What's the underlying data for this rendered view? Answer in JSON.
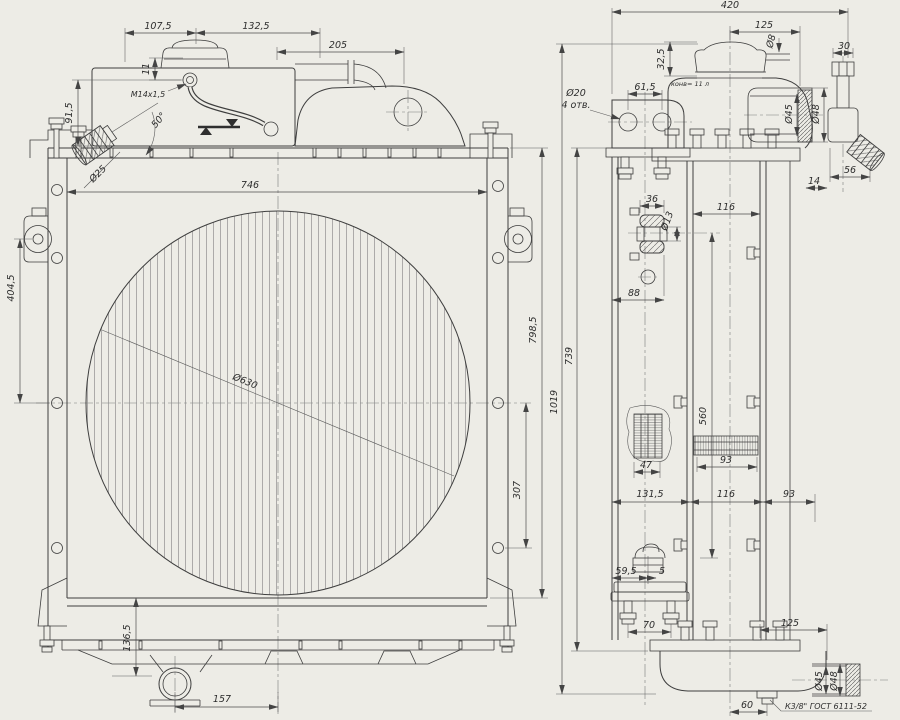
{
  "front": {
    "d107_5": "107,5",
    "d132_5": "132,5",
    "d205": "205",
    "d11": "11",
    "thread": "М14х1,5",
    "d91_5": "91,5",
    "a50": "50°",
    "d25": "Ø25",
    "d746": "746",
    "dfan": "Ø630",
    "d798_5": "798,5",
    "d307": "307",
    "d404_5": "404,5",
    "d136_5": "136,5",
    "d157": "157"
  },
  "side": {
    "d420": "420",
    "d125t": "125",
    "d8": "Ø8",
    "d32_5": "32,5",
    "d30": "30",
    "d20": "Ø20",
    "n4otv": "4 отв.",
    "d61_5": "61,5",
    "note_cap": "конв= 11 л",
    "d45t": "Ø45",
    "d48t": "Ø48",
    "d56": "56",
    "d14": "14",
    "d36": "36",
    "d13": "Ø13",
    "d116t": "116",
    "d88": "88",
    "d560": "560",
    "d47": "47",
    "d93m": "93",
    "d131_5": "131,5",
    "d116b": "116",
    "d93b": "93",
    "d1019": "1019",
    "d739": "739",
    "d59_5": "59,5",
    "d5": "5",
    "d70": "70",
    "d125b": "125",
    "d60": "60",
    "d45b": "Ø45",
    "d48b": "Ø48",
    "thread_note": "К3/8\" ГОСТ 6111-52"
  }
}
